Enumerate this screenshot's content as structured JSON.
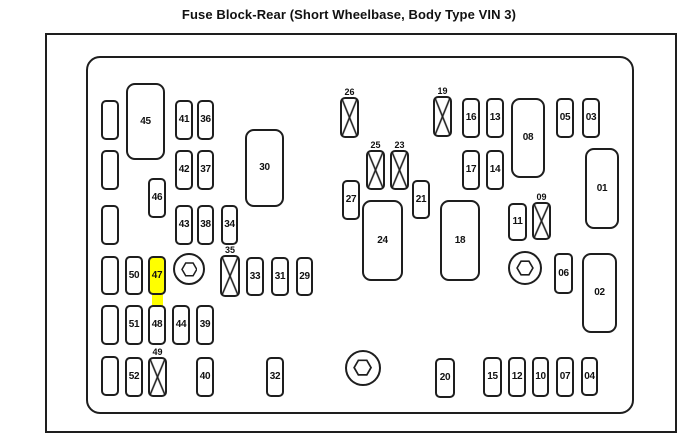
{
  "title": "Fuse Block-Rear (Short Wheelbase, Body Type VIN 3)",
  "colors": {
    "line": "#1e1e1e",
    "background": "#ffffff",
    "highlight": "#ffff00"
  },
  "highlighted_fuse": "47",
  "diagram": {
    "items": [
      {
        "type": "strip",
        "x": 152,
        "y": 294,
        "w": 11,
        "h": 14
      },
      {
        "type": "blank",
        "x": 101,
        "y": 100,
        "w": 18,
        "h": 40
      },
      {
        "type": "blank",
        "x": 101,
        "y": 150,
        "w": 18,
        "h": 40
      },
      {
        "type": "blank",
        "x": 101,
        "y": 205,
        "w": 18,
        "h": 40
      },
      {
        "type": "blank",
        "x": 101,
        "y": 256,
        "w": 18,
        "h": 39
      },
      {
        "type": "blank",
        "x": 101,
        "y": 305,
        "w": 18,
        "h": 40
      },
      {
        "type": "blank",
        "x": 101,
        "y": 356,
        "w": 18,
        "h": 40
      },
      {
        "type": "relay",
        "label": "45",
        "x": 126,
        "y": 83,
        "w": 39,
        "h": 77
      },
      {
        "type": "fuse",
        "label": "41",
        "x": 175,
        "y": 100,
        "w": 18,
        "h": 40
      },
      {
        "type": "fuse",
        "label": "36",
        "x": 197,
        "y": 100,
        "w": 17,
        "h": 40
      },
      {
        "type": "fuse",
        "label": "42",
        "x": 175,
        "y": 150,
        "w": 18,
        "h": 40
      },
      {
        "type": "fuse",
        "label": "37",
        "x": 197,
        "y": 150,
        "w": 17,
        "h": 40
      },
      {
        "type": "fuse",
        "label": "46",
        "x": 148,
        "y": 178,
        "w": 18,
        "h": 40
      },
      {
        "type": "fuse",
        "label": "43",
        "x": 175,
        "y": 205,
        "w": 18,
        "h": 40
      },
      {
        "type": "fuse",
        "label": "38",
        "x": 197,
        "y": 205,
        "w": 17,
        "h": 40
      },
      {
        "type": "fuse",
        "label": "34",
        "x": 221,
        "y": 205,
        "w": 17,
        "h": 40
      },
      {
        "type": "relay",
        "label": "30",
        "x": 245,
        "y": 129,
        "w": 39,
        "h": 78
      },
      {
        "type": "fuse",
        "label": "50",
        "x": 125,
        "y": 256,
        "w": 18,
        "h": 39
      },
      {
        "type": "fuse",
        "label": "47",
        "x": 148,
        "y": 256,
        "w": 18,
        "h": 39,
        "highlighted": true
      },
      {
        "type": "bolt",
        "x": 173,
        "y": 253,
        "w": 32,
        "h": 32
      },
      {
        "type": "crossed",
        "label": "35",
        "x": 220,
        "y": 255,
        "w": 20,
        "h": 42
      },
      {
        "type": "fuse",
        "label": "33",
        "x": 246,
        "y": 257,
        "w": 18,
        "h": 39
      },
      {
        "type": "fuse",
        "label": "31",
        "x": 271,
        "y": 257,
        "w": 18,
        "h": 39
      },
      {
        "type": "fuse",
        "label": "29",
        "x": 296,
        "y": 257,
        "w": 17,
        "h": 39
      },
      {
        "type": "fuse",
        "label": "51",
        "x": 125,
        "y": 305,
        "w": 18,
        "h": 40
      },
      {
        "type": "fuse",
        "label": "48",
        "x": 148,
        "y": 305,
        "w": 18,
        "h": 40
      },
      {
        "type": "fuse",
        "label": "44",
        "x": 172,
        "y": 305,
        "w": 18,
        "h": 40
      },
      {
        "type": "fuse",
        "label": "39",
        "x": 196,
        "y": 305,
        "w": 18,
        "h": 40
      },
      {
        "type": "fuse",
        "label": "52",
        "x": 125,
        "y": 357,
        "w": 18,
        "h": 40
      },
      {
        "type": "crossed",
        "label": "49",
        "x": 148,
        "y": 357,
        "w": 19,
        "h": 40
      },
      {
        "type": "fuse",
        "label": "40",
        "x": 196,
        "y": 357,
        "w": 18,
        "h": 40
      },
      {
        "type": "fuse",
        "label": "32",
        "x": 266,
        "y": 357,
        "w": 18,
        "h": 40
      },
      {
        "type": "crossed",
        "label": "26",
        "x": 340,
        "y": 97,
        "w": 19,
        "h": 41
      },
      {
        "type": "crossed",
        "label": "25",
        "x": 366,
        "y": 150,
        "w": 19,
        "h": 40
      },
      {
        "type": "crossed",
        "label": "23",
        "x": 390,
        "y": 150,
        "w": 19,
        "h": 40
      },
      {
        "type": "fuse",
        "label": "27",
        "x": 342,
        "y": 180,
        "w": 18,
        "h": 40
      },
      {
        "type": "fuse",
        "label": "21",
        "x": 412,
        "y": 180,
        "w": 18,
        "h": 39
      },
      {
        "type": "relay",
        "label": "24",
        "x": 362,
        "y": 200,
        "w": 41,
        "h": 81
      },
      {
        "type": "relay",
        "label": "18",
        "x": 440,
        "y": 200,
        "w": 40,
        "h": 81
      },
      {
        "type": "crossed",
        "label": "19",
        "x": 433,
        "y": 96,
        "w": 19,
        "h": 41
      },
      {
        "type": "fuse",
        "label": "16",
        "x": 462,
        "y": 98,
        "w": 18,
        "h": 40
      },
      {
        "type": "fuse",
        "label": "13",
        "x": 486,
        "y": 98,
        "w": 18,
        "h": 40
      },
      {
        "type": "fuse",
        "label": "17",
        "x": 462,
        "y": 150,
        "w": 18,
        "h": 40
      },
      {
        "type": "fuse",
        "label": "14",
        "x": 486,
        "y": 150,
        "w": 18,
        "h": 40
      },
      {
        "type": "relay",
        "label": "08",
        "x": 511,
        "y": 98,
        "w": 34,
        "h": 80
      },
      {
        "type": "fuse",
        "label": "11",
        "x": 508,
        "y": 203,
        "w": 19,
        "h": 38
      },
      {
        "type": "crossed",
        "label": "09",
        "x": 532,
        "y": 202,
        "w": 19,
        "h": 38
      },
      {
        "type": "fuse",
        "label": "05",
        "x": 556,
        "y": 98,
        "w": 18,
        "h": 40
      },
      {
        "type": "fuse",
        "label": "03",
        "x": 582,
        "y": 98,
        "w": 18,
        "h": 40
      },
      {
        "type": "relay",
        "label": "01",
        "x": 585,
        "y": 148,
        "w": 34,
        "h": 81
      },
      {
        "type": "bolt",
        "x": 508,
        "y": 251,
        "w": 34,
        "h": 34
      },
      {
        "type": "fuse",
        "label": "06",
        "x": 554,
        "y": 253,
        "w": 19,
        "h": 41
      },
      {
        "type": "relay",
        "label": "02",
        "x": 582,
        "y": 253,
        "w": 35,
        "h": 80
      },
      {
        "type": "bolt",
        "x": 345,
        "y": 350,
        "w": 36,
        "h": 36
      },
      {
        "type": "fuse",
        "label": "20",
        "x": 435,
        "y": 358,
        "w": 20,
        "h": 40
      },
      {
        "type": "fuse",
        "label": "15",
        "x": 483,
        "y": 357,
        "w": 19,
        "h": 40
      },
      {
        "type": "fuse",
        "label": "12",
        "x": 508,
        "y": 357,
        "w": 18,
        "h": 40
      },
      {
        "type": "fuse",
        "label": "10",
        "x": 532,
        "y": 357,
        "w": 17,
        "h": 40
      },
      {
        "type": "fuse",
        "label": "07",
        "x": 556,
        "y": 357,
        "w": 18,
        "h": 40
      },
      {
        "type": "fuse",
        "label": "04",
        "x": 581,
        "y": 357,
        "w": 17,
        "h": 39
      }
    ]
  }
}
